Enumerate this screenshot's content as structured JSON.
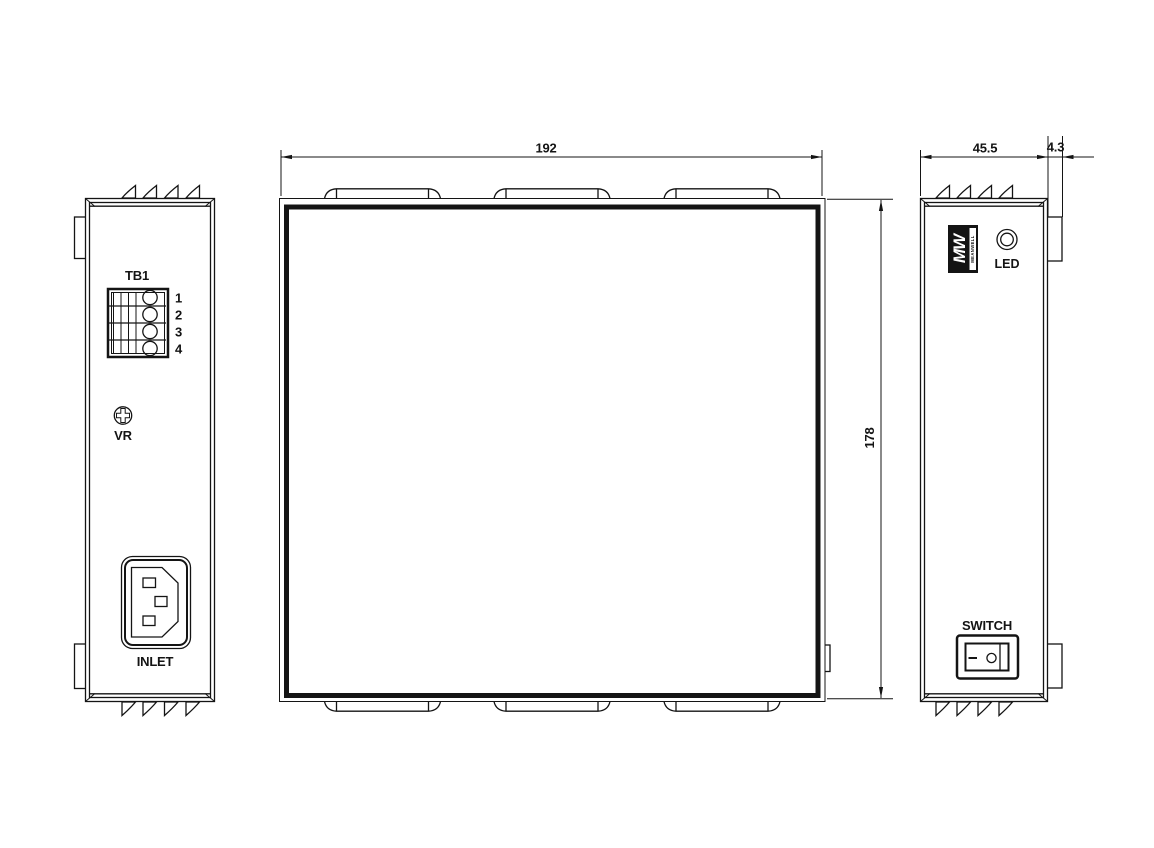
{
  "meta": {
    "drawing_type": "mechanical-dimension-drawing",
    "views": [
      "left-end-view",
      "top-view",
      "right-end-view"
    ]
  },
  "dims": {
    "width": "192",
    "depth": "178",
    "height": "45.5",
    "clip": "4.3"
  },
  "front_view": {
    "tb_label": "TB1",
    "pins": [
      "1",
      "2",
      "3",
      "4"
    ],
    "vr_label": "VR",
    "inlet_label": "INLET"
  },
  "side_view": {
    "logo": "MW",
    "logo_sub": "MEANWELL",
    "led": "LED",
    "switch": "SWITCH"
  },
  "colors": {
    "line": "#141414",
    "background": "#ffffff",
    "logo_fill": "#141414"
  }
}
